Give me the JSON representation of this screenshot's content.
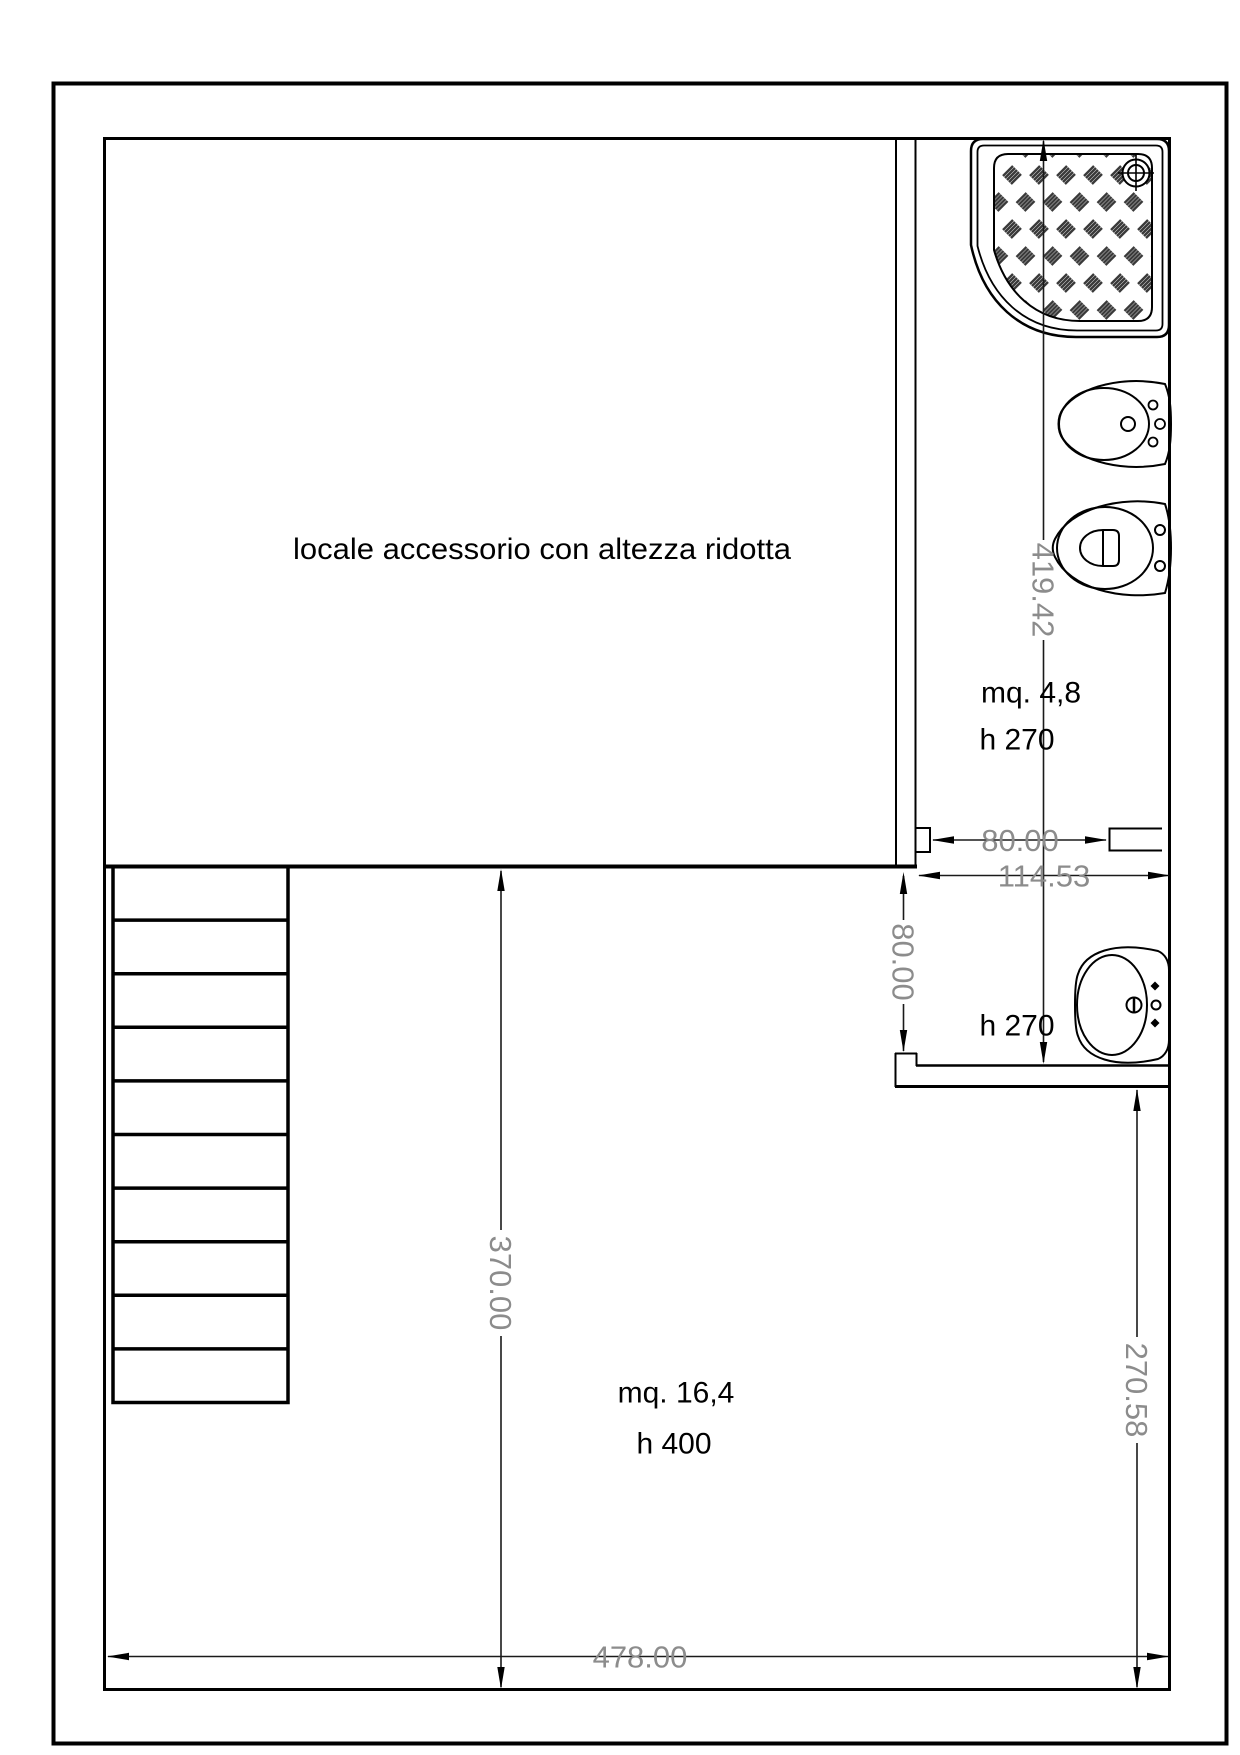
{
  "page": {
    "background": "#ffffff",
    "type": "architectural floor plan"
  },
  "labels": {
    "upper_room": "locale accessorio con altezza ridotta",
    "bath_area": "mq. 4,8",
    "bath_height": "h 270",
    "vestibule_height": "h 270",
    "lower_room_area": "mq. 16,4",
    "lower_room_height": "h 400"
  },
  "dims": {
    "bath_depth": "419.42",
    "door_width": "80.00",
    "bath_width": "114.53",
    "passage_width": "80.00",
    "lower_room_depth": "370.00",
    "right_side_depth": "270.58",
    "total_width": "478.00"
  },
  "colors": {
    "wall_line": "#000000",
    "dimension_text": "#8c8c8c",
    "hatch_stroke": "#3a3a3a"
  },
  "fixtures": {
    "shower": "shower-tray",
    "bidet": "bidet",
    "toilet": "toilet",
    "washbasin": "washbasin",
    "stairs": "staircase-10-treads"
  }
}
